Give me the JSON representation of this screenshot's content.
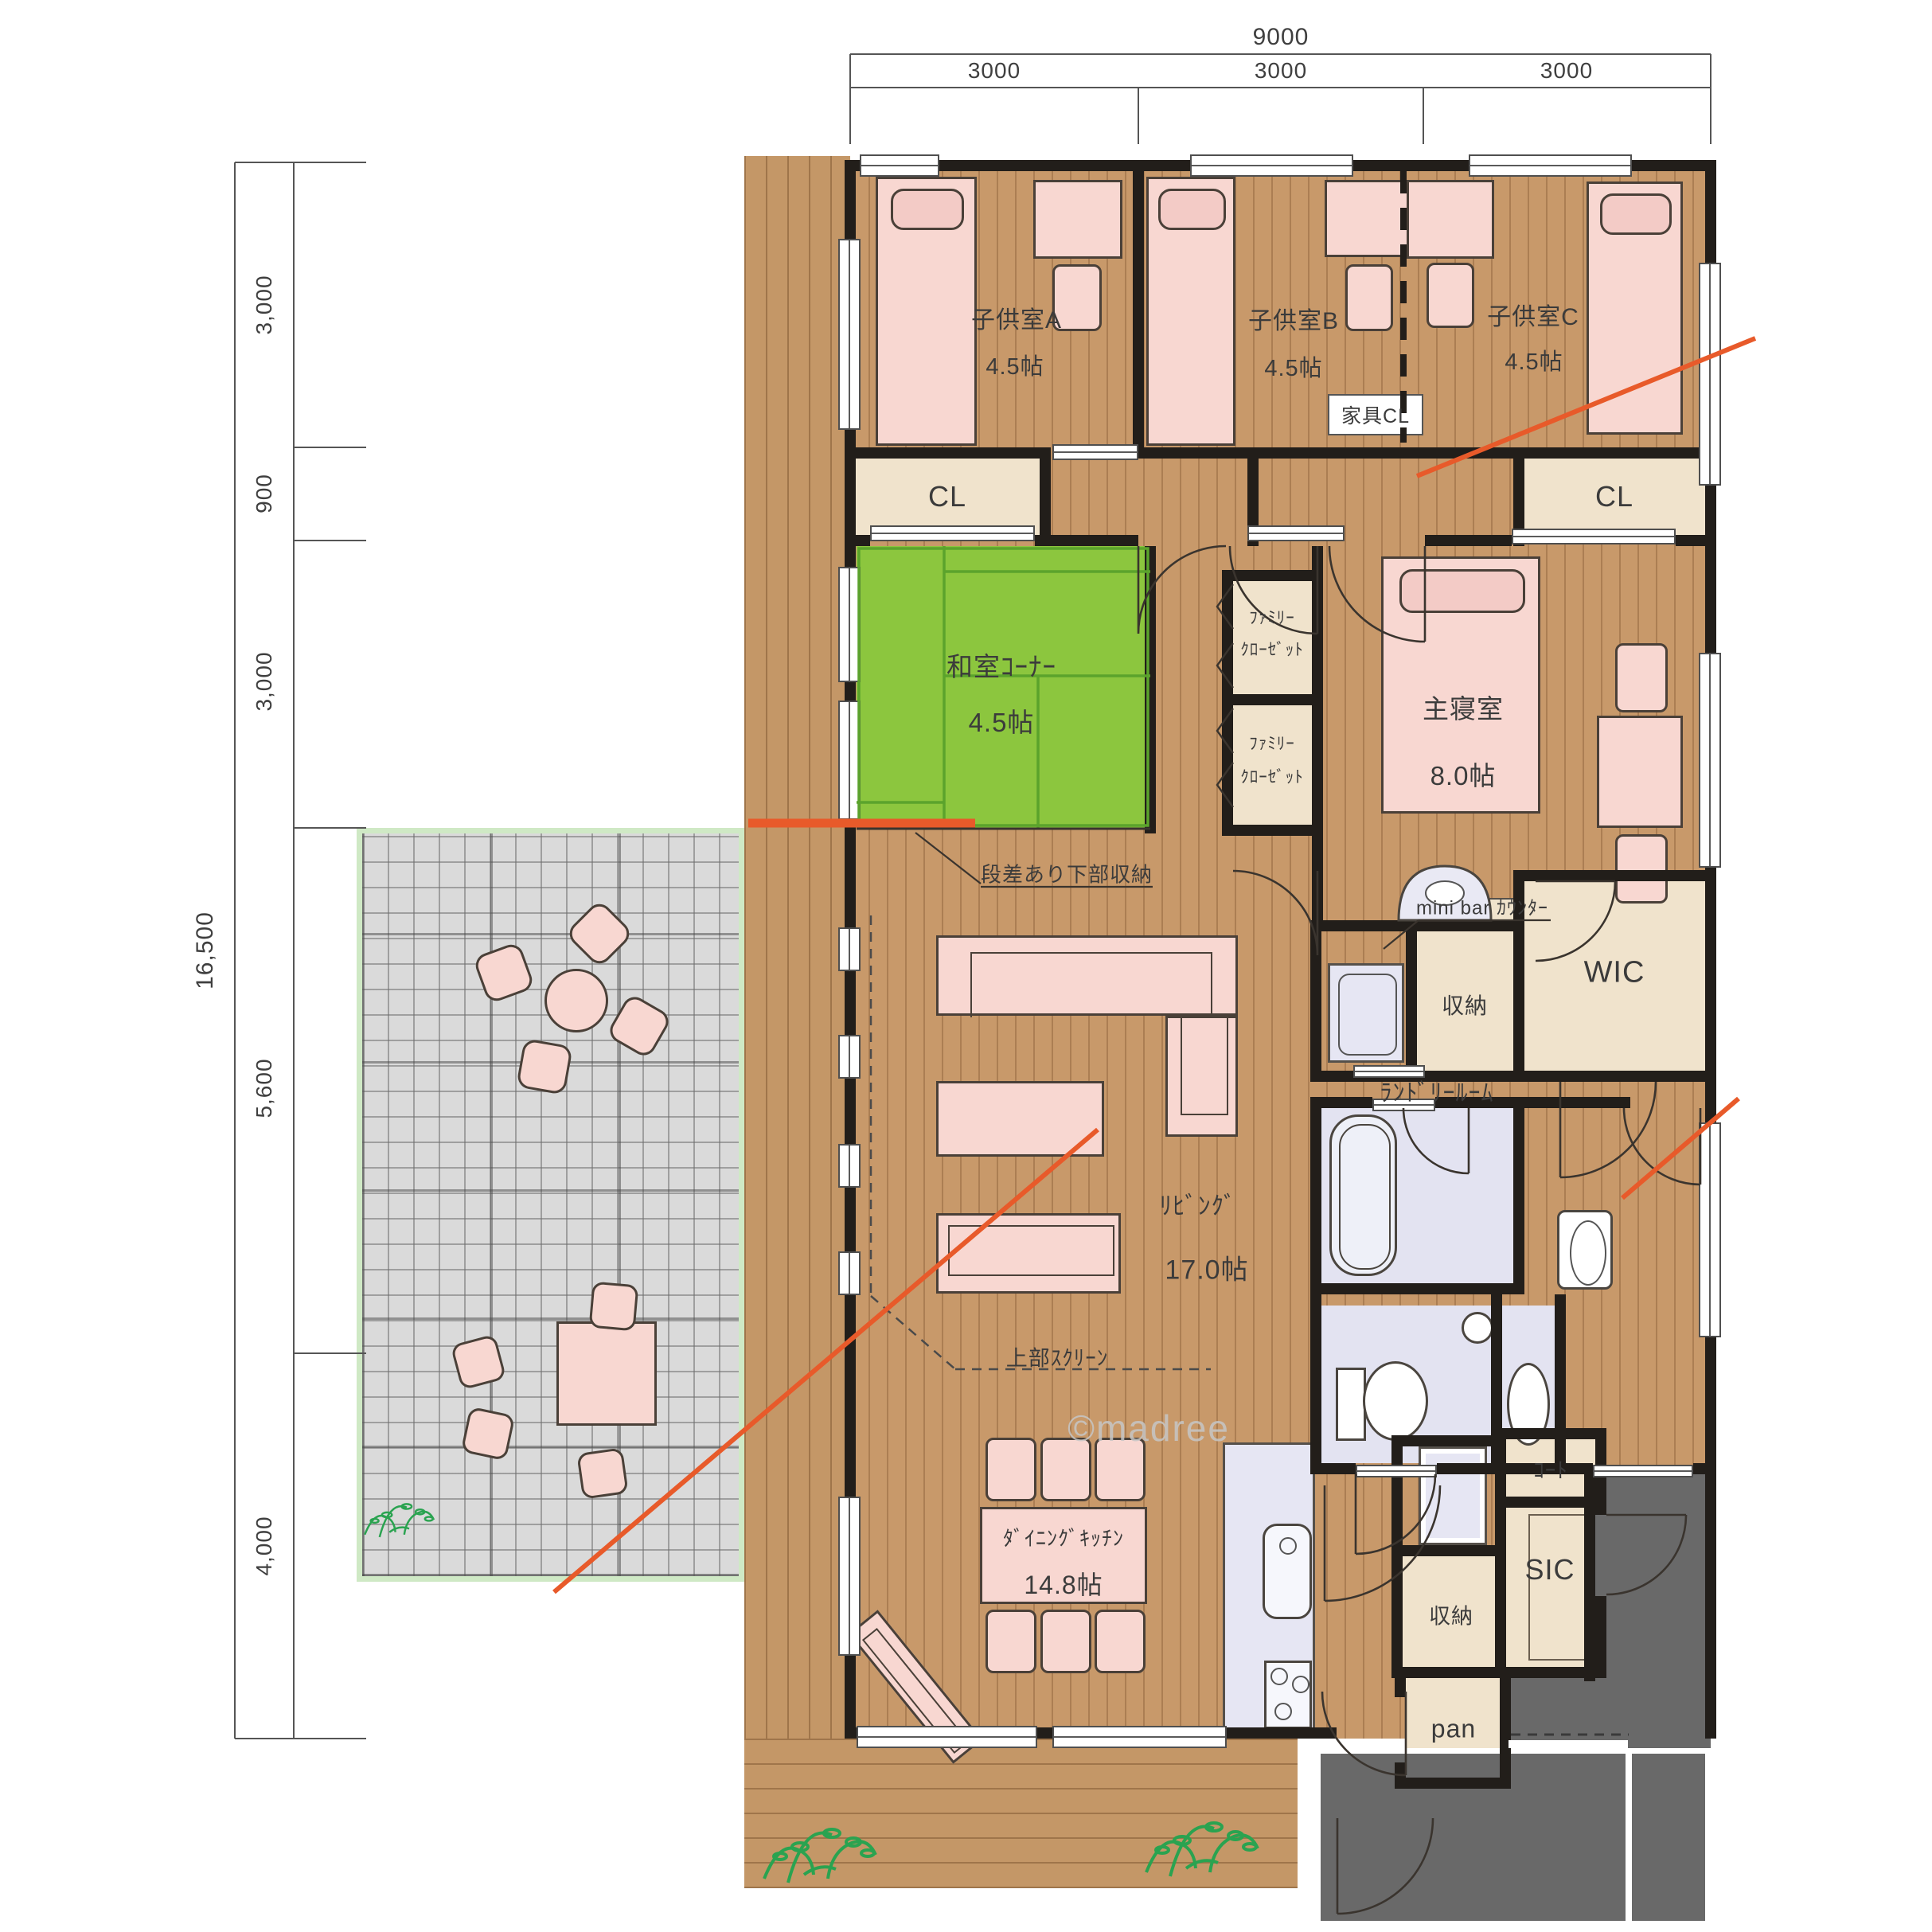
{
  "dimensions": {
    "top": {
      "total": "9000",
      "segments": [
        "3000",
        "3000",
        "3000"
      ]
    },
    "left": {
      "total": "16,500",
      "segments": [
        "3,000",
        "900",
        "3,000",
        "5,600",
        "4,000"
      ]
    }
  },
  "rooms": {
    "child_a": {
      "name": "子供室A",
      "size": "4.5帖"
    },
    "child_b": {
      "name": "子供室B",
      "size": "4.5帖"
    },
    "child_c": {
      "name": "子供室C",
      "size": "4.5帖"
    },
    "closet_left": {
      "name": "CL"
    },
    "closet_right": {
      "name": "CL"
    },
    "furniture_closet": {
      "name": "家具CL"
    },
    "washitsu": {
      "name": "和室ｺｰﾅｰ",
      "size": "4.5帖",
      "note": "段差あり下部収納"
    },
    "family_closet_upper": {
      "line1": "ﾌｧﾐﾘｰ",
      "line2": "ｸﾛｰｾﾞｯﾄ"
    },
    "family_closet_lower": {
      "line1": "ﾌｧﾐﾘｰ",
      "line2": "ｸﾛｰｾﾞｯﾄ"
    },
    "master": {
      "name": "主寝室",
      "size": "8.0帖"
    },
    "minibar": {
      "name": "mini bar ｶｳﾝﾀｰ"
    },
    "wic": {
      "name": "WIC"
    },
    "storage_laundry": {
      "name": "収納"
    },
    "laundry": {
      "name": "ﾗﾝﾄﾞﾘｰﾙｰﾑ"
    },
    "living": {
      "name": "ﾘﾋﾞﾝｸﾞ",
      "size": "17.0帖"
    },
    "screen": {
      "name": "上部ｽｸﾘｰﾝ"
    },
    "dining": {
      "name": "ﾀﾞｲﾆﾝｸﾞｷｯﾁﾝ",
      "size": "14.8帖"
    },
    "storage_hall": {
      "name": "収納"
    },
    "coat": {
      "name": "ｺｰﾄ"
    },
    "sic": {
      "name": "SIC"
    },
    "pantry": {
      "name": "pan"
    }
  },
  "watermark": "©madree",
  "colors": {
    "floor": "#c8996a",
    "tatami": "#8cc63e",
    "wall": "#221e1a",
    "closet": "#f0e3cc",
    "fixture": "#e3e3f1",
    "furniture": "#f8d7d1",
    "terrace": "#dadada",
    "terrace_edge": "#cfe9c5",
    "entrance": "#696969",
    "accent_line": "#e85a2a"
  }
}
